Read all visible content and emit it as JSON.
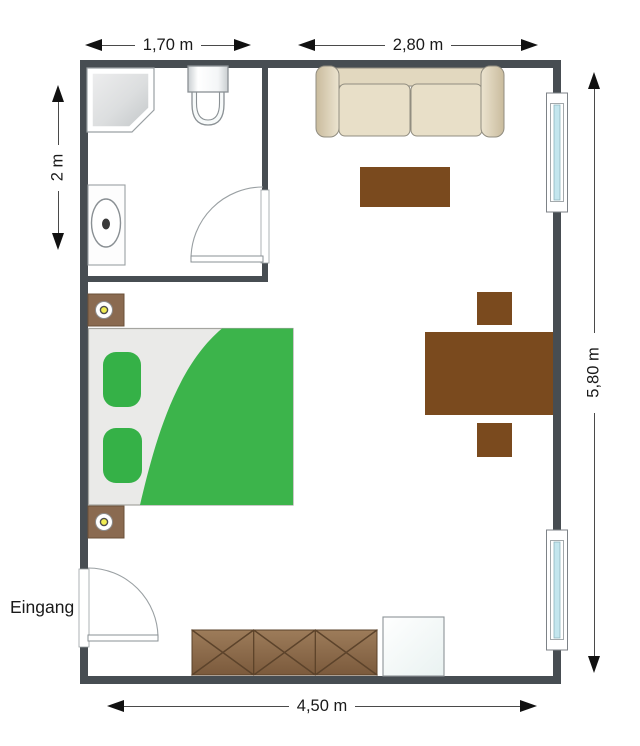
{
  "floorplan": {
    "entrance_label": "Eingang",
    "dims": {
      "bath_width": "1,70 m",
      "living_width": "2,80 m",
      "bath_depth": "2 m",
      "apartment_depth": "5,80 m",
      "apartment_width": "4,50 m"
    },
    "colors": {
      "wall": "#474d52",
      "dimension_line": "#4a4a4a",
      "arrowhead": "#111111",
      "text": "#1a1a1a",
      "duvet_green": "#3cb44b",
      "pillow_green": "#35b147",
      "table_brown": "#7a4a1e",
      "dresser_brown": "#8a6746",
      "nightstand_brown": "#8a6a50",
      "sofa_beige": "#e6dcc4",
      "sofa_arm_tan": "#c6b89a",
      "window_glass_blue": "#c3e6ee",
      "mattress_gray": "#eaeae8",
      "fixture_white": "#fafbfb",
      "lamp_yellow": "#f0ec52"
    },
    "furniture": [
      {
        "name": "shower"
      },
      {
        "name": "toilet"
      },
      {
        "name": "sink-vanity"
      },
      {
        "name": "bathroom-door"
      },
      {
        "name": "entrance-door"
      },
      {
        "name": "bed"
      },
      {
        "name": "nightstand-top"
      },
      {
        "name": "nightstand-bottom"
      },
      {
        "name": "sofa"
      },
      {
        "name": "coffee-table"
      },
      {
        "name": "dining-table"
      },
      {
        "name": "dining-chair-top"
      },
      {
        "name": "dining-chair-bottom"
      },
      {
        "name": "sideboard"
      },
      {
        "name": "cabinet"
      },
      {
        "name": "window-upper"
      },
      {
        "name": "window-lower"
      }
    ]
  }
}
